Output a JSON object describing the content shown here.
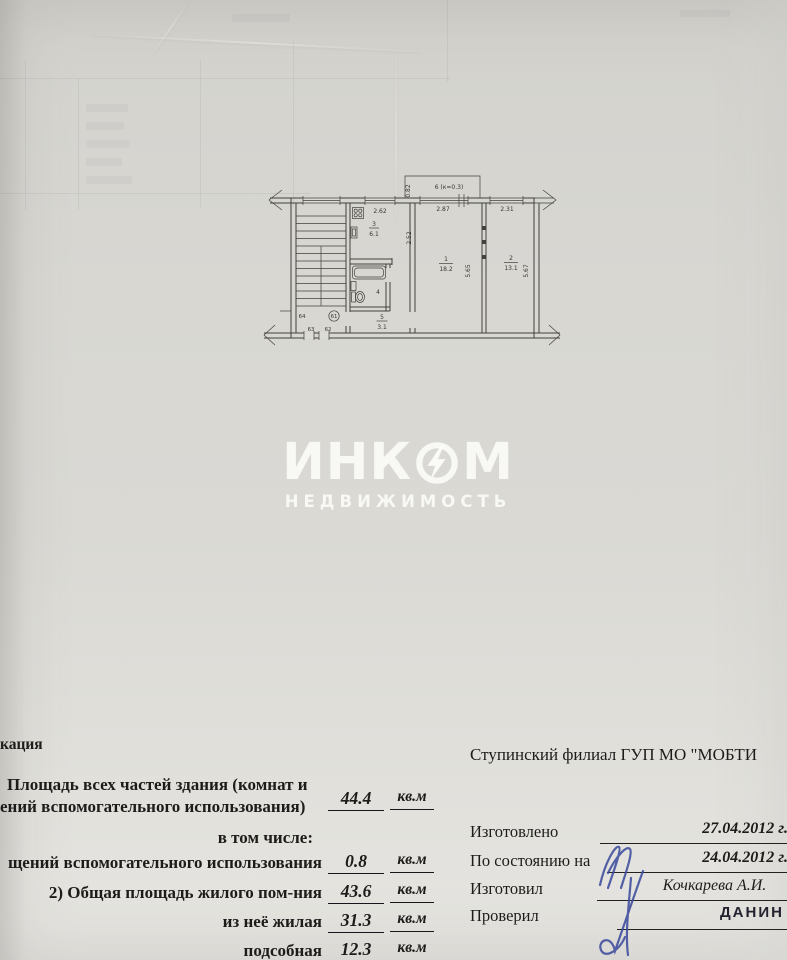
{
  "watermark": {
    "brand_left": "ИНК",
    "brand_right": "М",
    "subtitle": "НЕДВИЖИМОСТЬ"
  },
  "plan": {
    "balcony": {
      "label": "6 (к=0.3)",
      "width_dim": "0.82"
    },
    "dims": {
      "kitchen_top": "2.62",
      "room1_top": "2.87",
      "room2_top": "2.31",
      "kitchen_side": "2.52",
      "room1_side": "5.65",
      "room2_side": "5.67"
    },
    "rooms": {
      "living1": {
        "num": "1",
        "area": "18.2"
      },
      "living2": {
        "num": "2",
        "area": "13.1"
      },
      "kitchen": {
        "num": "3",
        "area": "6.1"
      },
      "bathroom": {
        "num": "4"
      },
      "hall": {
        "num": "5",
        "area": "3.1"
      }
    },
    "landing": {
      "apt_64": "64",
      "apt_circled": "61",
      "apt_63": "63",
      "apt_62": "62"
    }
  },
  "explication": {
    "heading_fragment": "кация",
    "row1": {
      "line1": "Площадь всех частей здания (комнат и",
      "line2": "ений вспомогательного использования)",
      "value": "44.4",
      "unit": "кв.м"
    },
    "including": "в том числе:",
    "row2": {
      "label": "щений вспомогательного использования",
      "value": "0.8",
      "unit": "кв.м"
    },
    "row3": {
      "label": "2) Общая площадь жилого пом-ния",
      "value": "43.6",
      "unit": "кв.м"
    },
    "row4": {
      "label": "из неё жилая",
      "value": "31.3",
      "unit": "кв.м"
    },
    "row5": {
      "label": "подсобная",
      "value": "12.3",
      "unit": "кв.м"
    }
  },
  "office": {
    "org": "Ступинский филиал ГУП МО \"МОБТИ",
    "made_label": "Изготовлено",
    "made_value": "27.04.2012 г.",
    "asof_label": "По состоянию на",
    "asof_value": "24.04.2012 г.",
    "author_label": "Изготовил",
    "author_value": "Кочкарева А.И.",
    "checker_label": "Проверил",
    "checker_stamp": "ДАНИН Е"
  }
}
